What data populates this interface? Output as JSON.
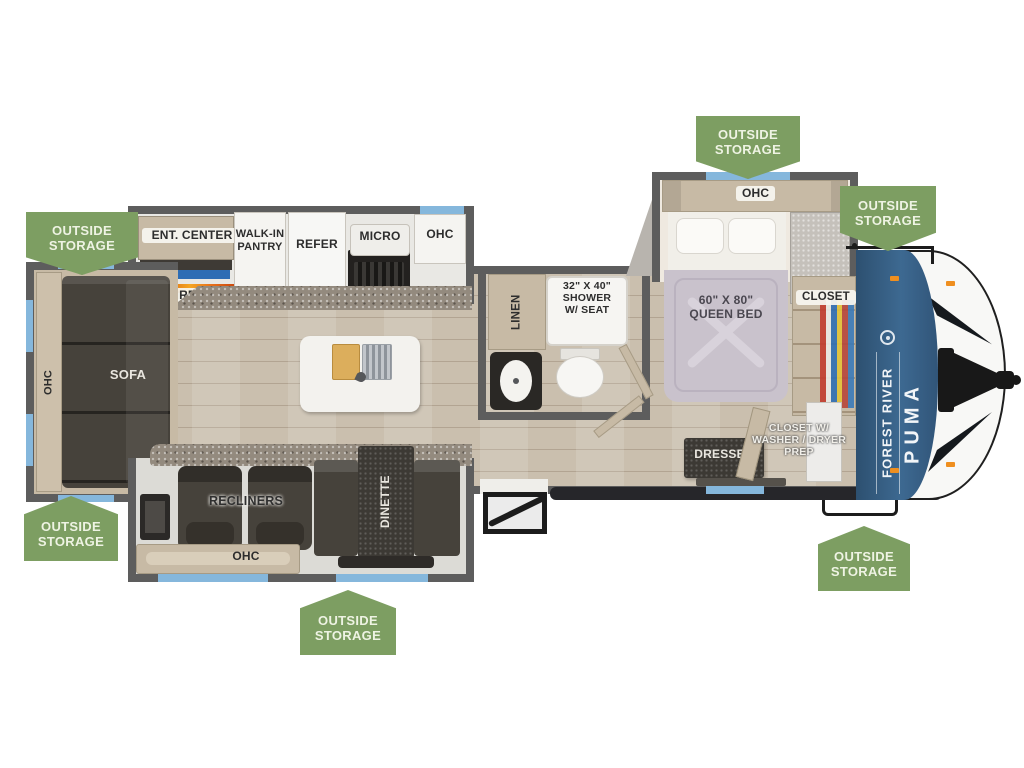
{
  "badge": {
    "line1": "OUTSIDE",
    "line2": "STORAGE"
  },
  "brand": {
    "manufacturer": "FOREST RIVER",
    "model": "PUMA"
  },
  "colors": {
    "badge_green": "#7d9e62",
    "wall_gray": "#5d5d5d",
    "window_blue": "#85b7dc",
    "brand_band_blue": "#3a628c",
    "tv_blue": "#2e6db4",
    "flame_orange": "#e87722",
    "quilt_lavender": "#c9c2cc",
    "cabinet_tan": "#c7baa5"
  },
  "labels": {
    "ent_center": "ENT. CENTER",
    "walk_in_pantry_line1": "WALK-IN",
    "walk_in_pantry_line2": "PANTRY",
    "refer": "REFER",
    "micro": "MICRO",
    "ohc": "OHC",
    "fireplace": "FIREPLACE",
    "sofa": "SOFA",
    "linen": "LINEN",
    "shower_line1": "32\" X 40\"",
    "shower_line2": "SHOWER",
    "shower_line3": "W/ SEAT",
    "queen_bed_line1": "60\" X 80\"",
    "queen_bed_line2": "QUEEN BED",
    "closet": "CLOSET",
    "dresser": "DRESSER",
    "closet_wd_line1": "CLOSET W/",
    "closet_wd_line2": "WASHER / DRYER",
    "closet_wd_line3": "PREP",
    "recliners": "RECLINERS",
    "dinette": "DINETTE"
  }
}
